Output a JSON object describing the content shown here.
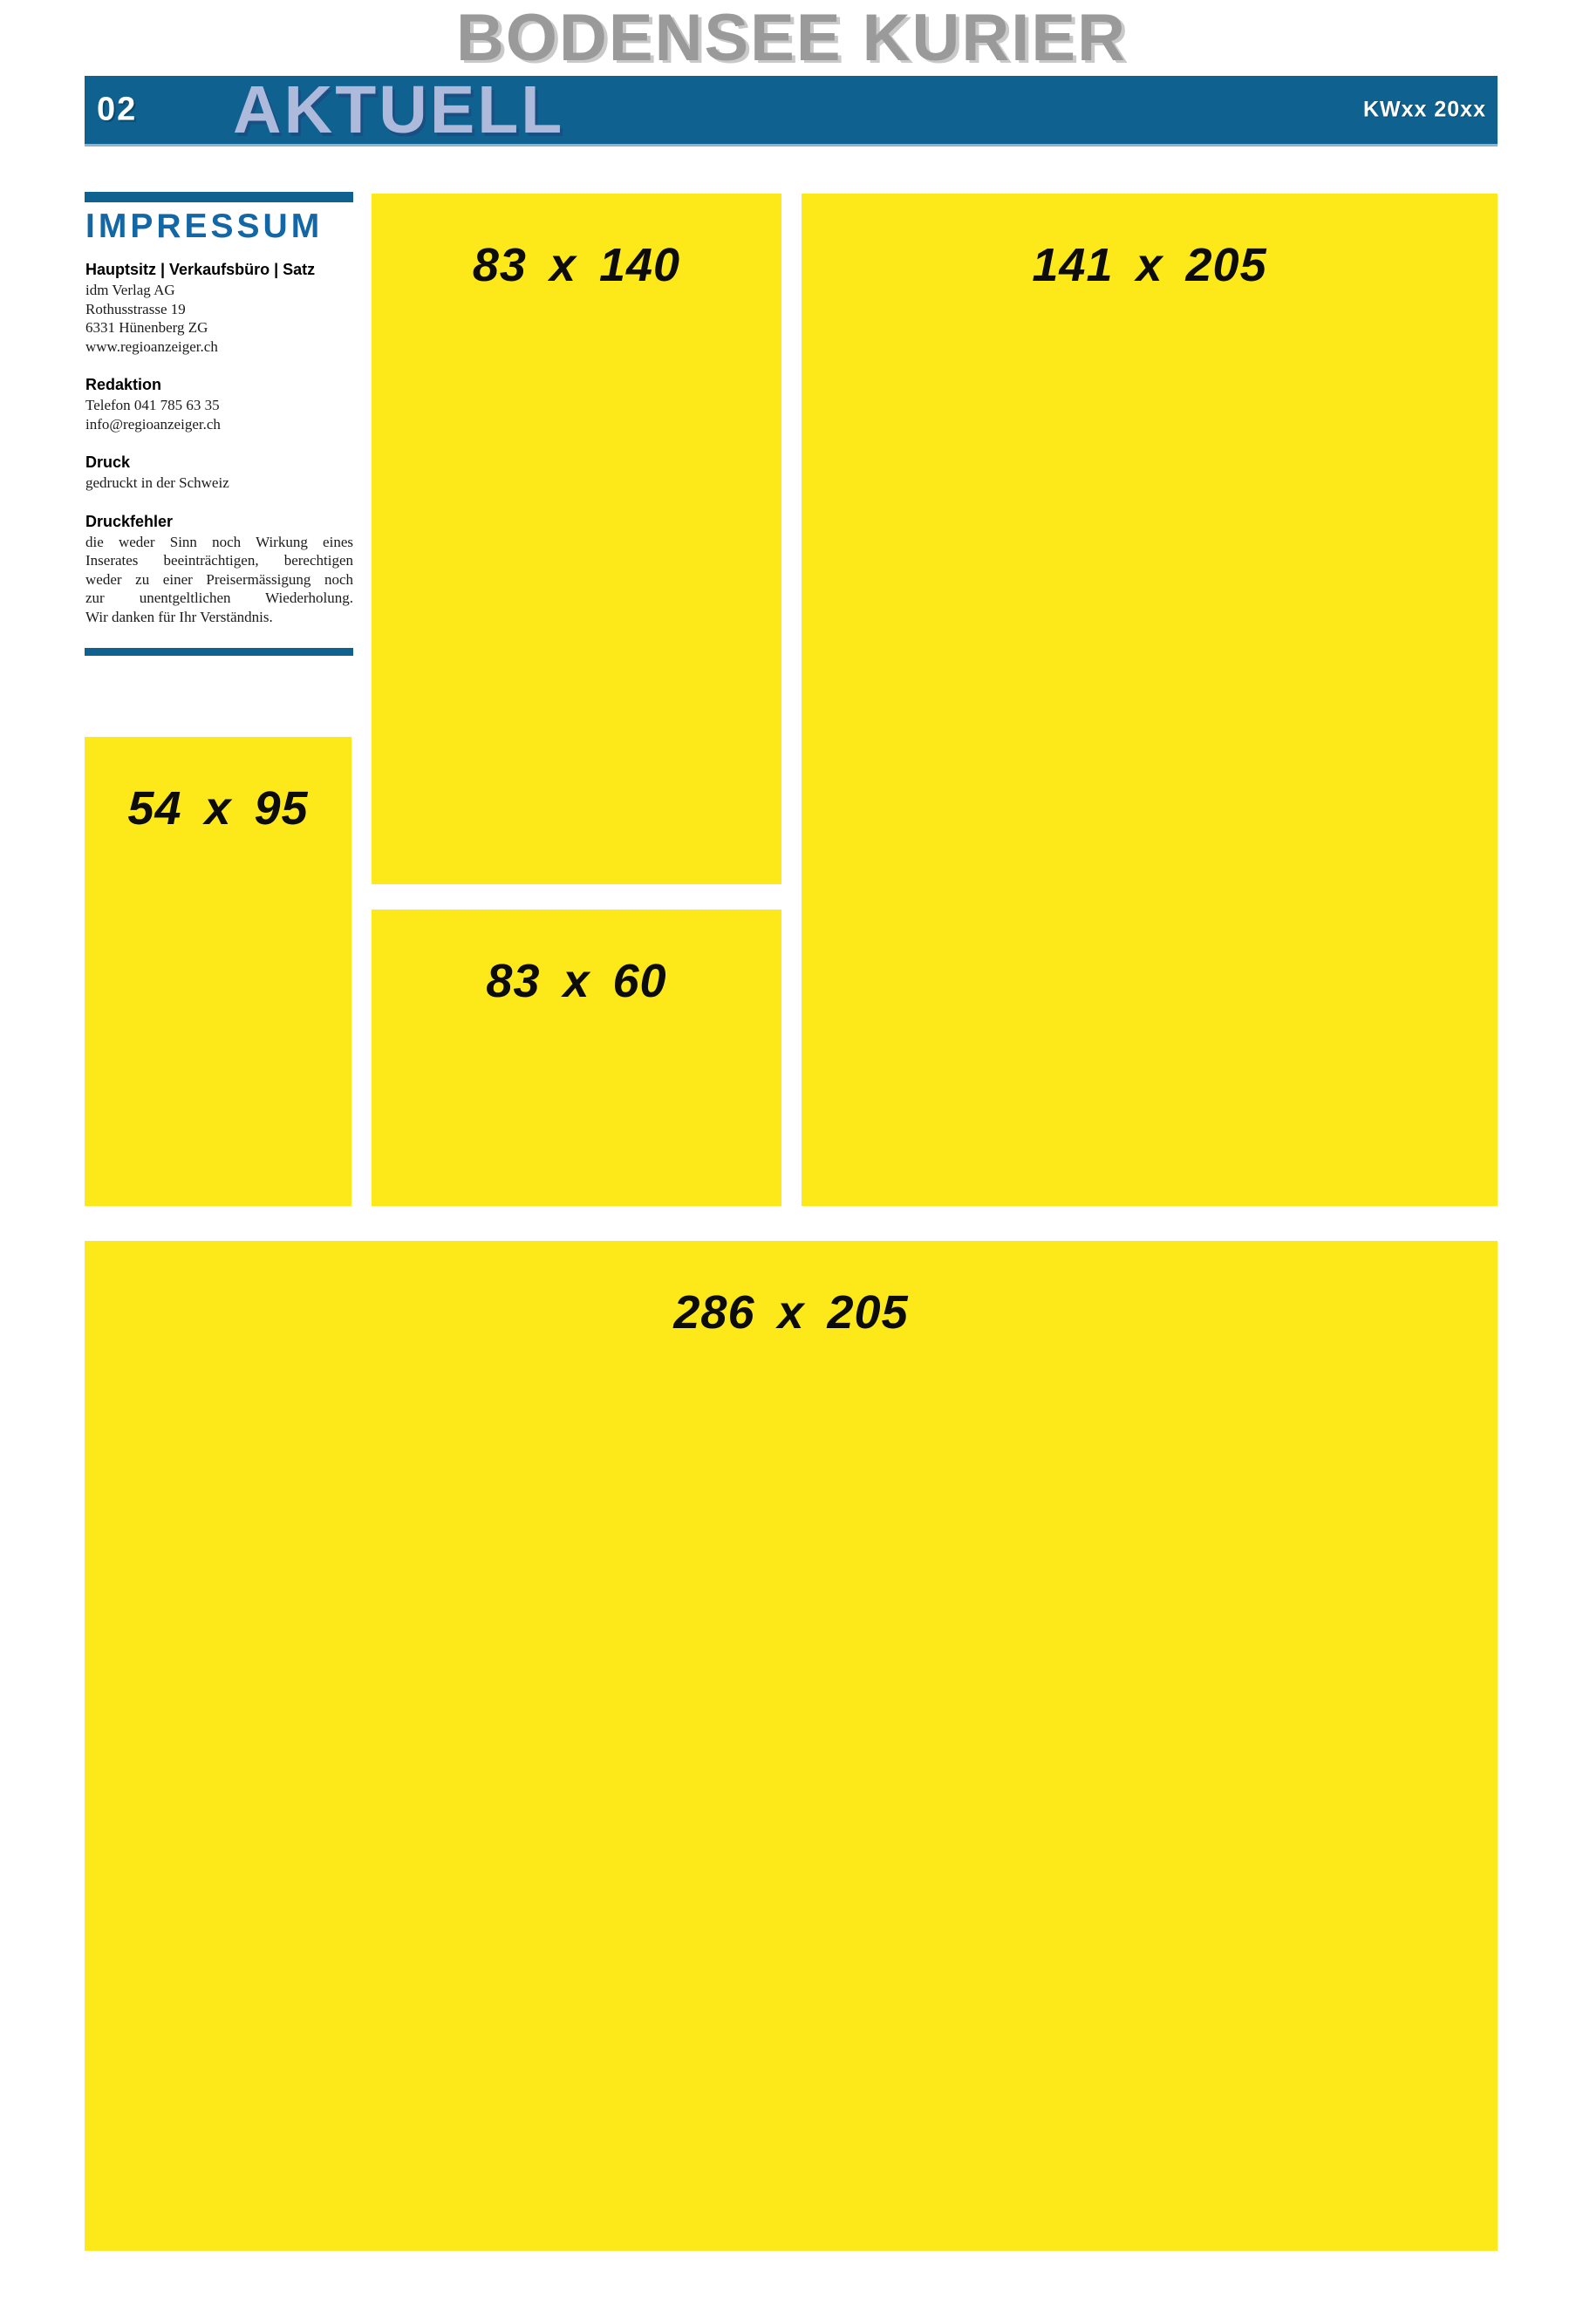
{
  "masthead": {
    "title": "BODENSEE KURIER"
  },
  "section_bar": {
    "page_number": "02",
    "section_title": "AKTUELL",
    "issue": "KWxx 20xx"
  },
  "impressum": {
    "title": "IMPRESSUM",
    "sections": [
      {
        "heading": "Hauptsitz | Verkaufsbüro | Satz",
        "lines": [
          "idm Verlag AG",
          "Rothusstrasse 19",
          "6331 Hünenberg ZG",
          "www.regioanzeiger.ch"
        ]
      },
      {
        "heading": "Redaktion",
        "lines": [
          "Telefon 041 785 63 35",
          "info@regioanzeiger.ch"
        ]
      },
      {
        "heading": "Druck",
        "lines": [
          "gedruckt in der Schweiz"
        ]
      },
      {
        "heading": "Druckfehler",
        "lines": [
          "die weder Sinn noch Wirkung eines",
          "Inserates beeinträchtigen, berechtigen",
          "weder zu einer Preisermässigung noch",
          "zur unentgeltlichen Wiederholung.",
          "Wir danken für Ihr Verständnis."
        ]
      }
    ]
  },
  "ad_slots": [
    {
      "label": "83 x 140"
    },
    {
      "label": "141 x 205"
    },
    {
      "label": "54 x 95"
    },
    {
      "label": "83 x 60"
    },
    {
      "label": "286 x 205"
    }
  ],
  "colors": {
    "bar_blue": "#0f618f",
    "impressum_title_blue": "#1367a4",
    "slot_yellow": "#fde81a",
    "masthead_gray": "#9a9a9a",
    "section_title_lavender": "#aebadc"
  }
}
